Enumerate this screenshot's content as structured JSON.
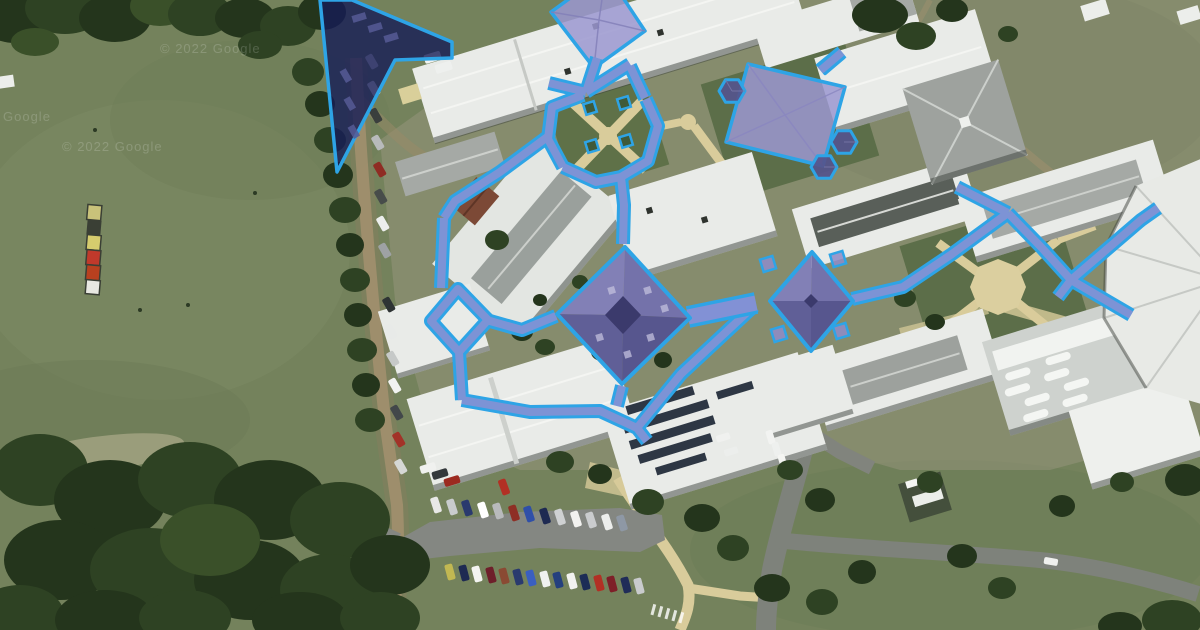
{
  "meta": {
    "view_type": "satellite-imagery",
    "scene": "school-campus-aerial-with-highlighted-space-overlays"
  },
  "watermarks": {
    "full": "© 2022 Google",
    "short": "Google"
  },
  "palette": {
    "overlay-stroke": "#2ea4e6",
    "overlay-walkway-fill": "#918ed1",
    "overlay-building-fill": "#9b98d0",
    "overlay-pyramid-dark": "#57568e",
    "overlay-dark-zone": "#151b56",
    "field-green": "#74825c",
    "lawn-green": "#5d7048",
    "tree-green": "#24351c",
    "roof-white": "#e9ebe8",
    "roof-gray": "#a5a9a5",
    "path-tan": "#d9cc9b",
    "road-asphalt": "#7e827b"
  },
  "overlays": {
    "features": [
      {
        "id": "dark-zone-triangle",
        "kind": "zone"
      },
      {
        "id": "pyramid-roof-top",
        "kind": "building"
      },
      {
        "id": "square-roof-east",
        "kind": "building"
      },
      {
        "id": "pyramid-roof-central",
        "kind": "building"
      },
      {
        "id": "pyramid-roof-east",
        "kind": "building"
      },
      {
        "id": "hex-shelters",
        "kind": "shelter"
      },
      {
        "id": "courtyard-planters",
        "kind": "planter"
      },
      {
        "id": "covered-walkway-network",
        "kind": "walkway"
      }
    ]
  }
}
